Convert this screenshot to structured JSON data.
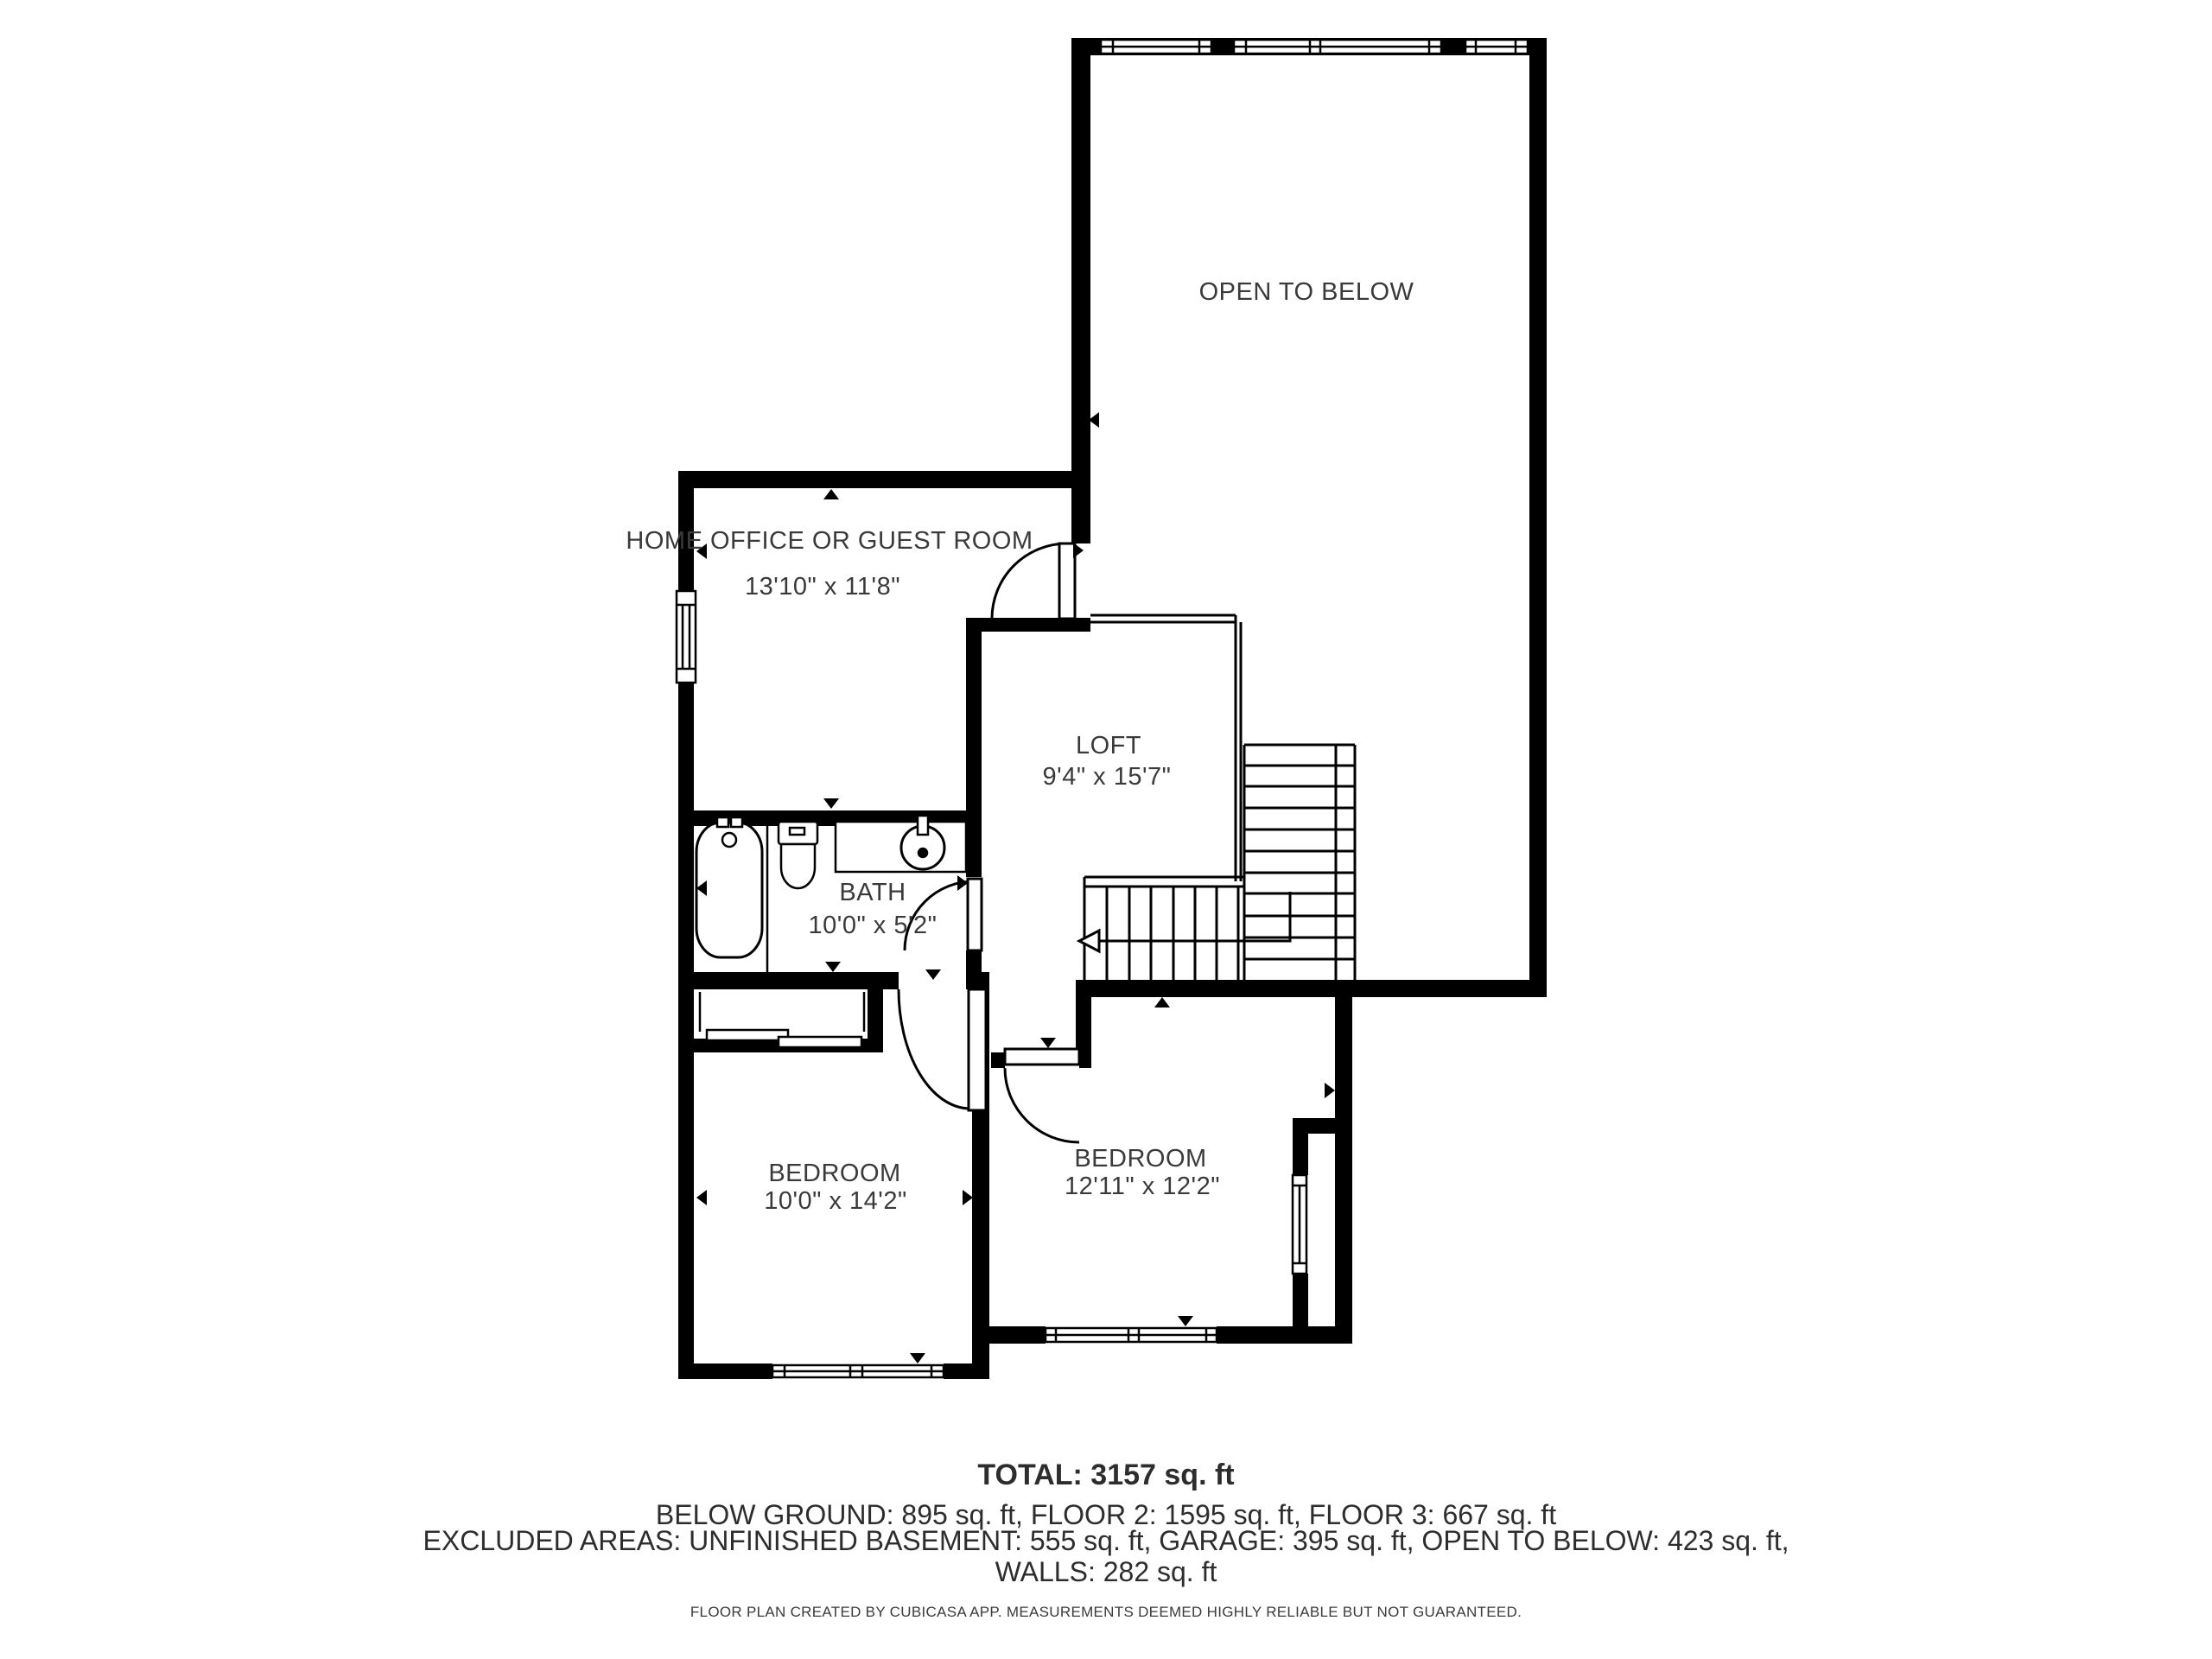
{
  "floorplan": {
    "rooms": [
      {
        "name": "OPEN TO BELOW",
        "dims": ""
      },
      {
        "name": "HOME OFFICE OR GUEST ROOM",
        "dims": "13'10\" x 11'8\""
      },
      {
        "name": "LOFT",
        "dims": "9'4\" x 15'7\""
      },
      {
        "name": "BATH",
        "dims": "10'0\" x 5'2\""
      },
      {
        "name": "BEDROOM",
        "dims": "10'0\" x 14'2\""
      },
      {
        "name": "BEDROOM",
        "dims": "12'11\" x 12'2\""
      }
    ],
    "colors": {
      "wall": "#000000",
      "text": "#3a3a3a",
      "background": "#ffffff"
    }
  },
  "footer": {
    "total": "TOTAL: 3157 sq. ft",
    "line2": "BELOW GROUND: 895 sq. ft, FLOOR 2: 1595 sq. ft, FLOOR 3: 667 sq. ft",
    "line3": "EXCLUDED AREAS: UNFINISHED BASEMENT: 555 sq. ft, GARAGE: 395 sq. ft, OPEN TO BELOW: 423 sq. ft,",
    "line4": "WALLS: 282 sq. ft",
    "disclaimer": "FLOOR PLAN CREATED BY CUBICASA APP. MEASUREMENTS DEEMED HIGHLY RELIABLE BUT NOT GUARANTEED."
  }
}
